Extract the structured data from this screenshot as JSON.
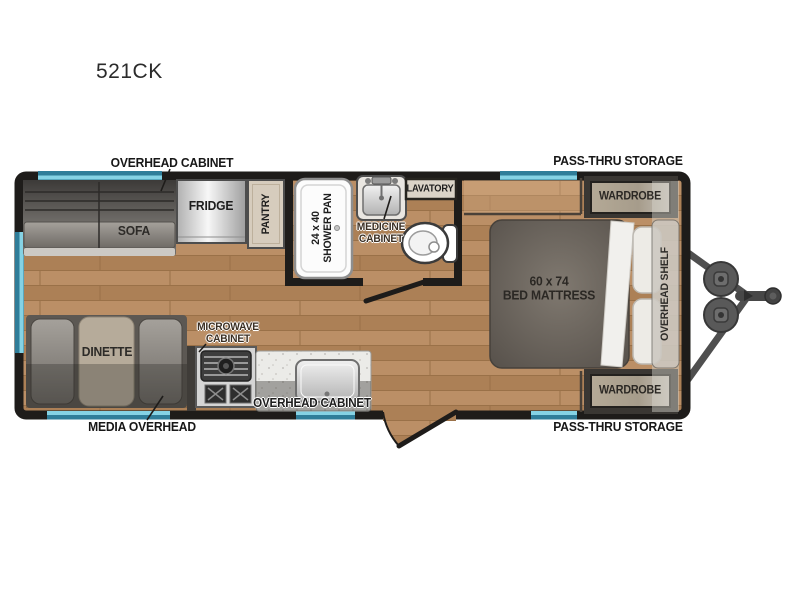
{
  "title": "521CK",
  "colors": {
    "wall": "#1e1c1a",
    "floor": "#b4885f",
    "window_dark": "#2f7d99",
    "window_light": "#85d2e4",
    "label": "#1d1d1d"
  },
  "exterior_labels": {
    "overhead_cabinet_top": "OVERHEAD CABINET",
    "pass_thru_top": "PASS-THRU STORAGE",
    "media_overhead": "MEDIA OVERHEAD",
    "pass_thru_bottom": "PASS-THRU STORAGE"
  },
  "rooms": {
    "sofa": "SOFA",
    "fridge": "FRIDGE",
    "pantry": "PANTRY",
    "shower": "24 x 40\nSHOWER PAN",
    "lavatory": "LAVATORY",
    "medicine_cabinet": "MEDICINE\nCABINET",
    "bed": "60 x 74\nBED MATTRESS",
    "wardrobe_top": "WARDROBE",
    "wardrobe_bottom": "WARDROBE",
    "overhead_shelf": "OVERHEAD SHELF",
    "dinette": "DINETTE",
    "microwave_cabinet": "MICROWAVE\nCABINET",
    "overhead_cabinet_kitchen": "OVERHEAD CABINET"
  }
}
